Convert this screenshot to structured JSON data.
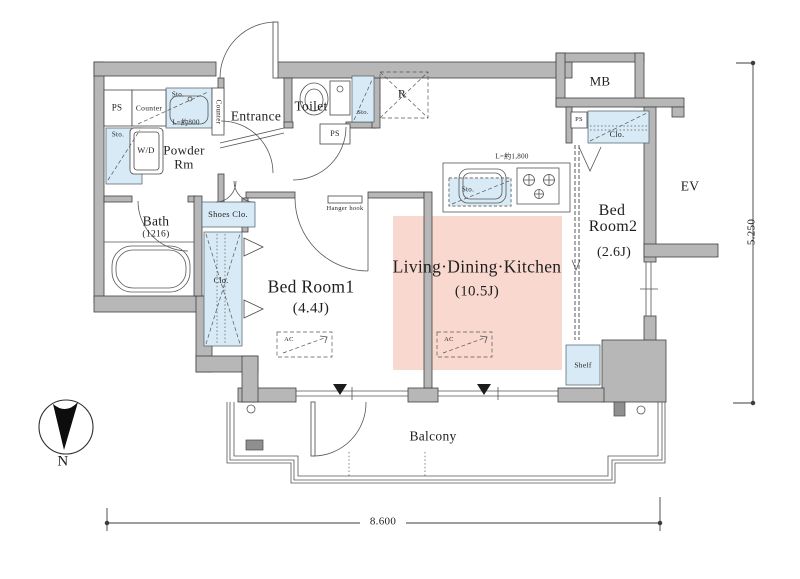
{
  "document": {
    "kind": "apartment-floor-plan"
  },
  "colors": {
    "wall_gray": "#b7b7b7",
    "outline": "#404040",
    "storage_blue": "#d8eaf5",
    "ldk_pink": "#f9d9cf",
    "line": "#555555",
    "text": "#1f1f1f"
  },
  "rooms": {
    "entrance": "Entrance",
    "toilet": "Toilet",
    "powder_line1": "Powder",
    "powder_line2": "Rm",
    "bath": "Bath",
    "bath_size": "(1216)",
    "bedroom1": "Bed Room1",
    "bedroom1_size": "(4.4J)",
    "bedroom2_line1": "Bed",
    "bedroom2_line2": "Room2",
    "bedroom2_size": "(2.6J)",
    "ldk": "Living·Dining·Kitchen",
    "ldk_size": "(10.5J)",
    "balcony": "Balcony",
    "ev": "EV",
    "mb": "MB"
  },
  "fixtures": {
    "ps": "PS",
    "sto": "Sto.",
    "clo": "Clo.",
    "counter": "Counter",
    "wd": "W/D",
    "shoes_clo": "Shoes Clo.",
    "shelf": "Shelf",
    "hanger_hook": "Hanger hook",
    "ac": "AC",
    "refrigerator": "R",
    "counter_length": "L=約800",
    "kitchen_length": "L=約1,800"
  },
  "dimensions": {
    "width": "8.600",
    "height": "5.250"
  },
  "compass": {
    "north": "N"
  }
}
